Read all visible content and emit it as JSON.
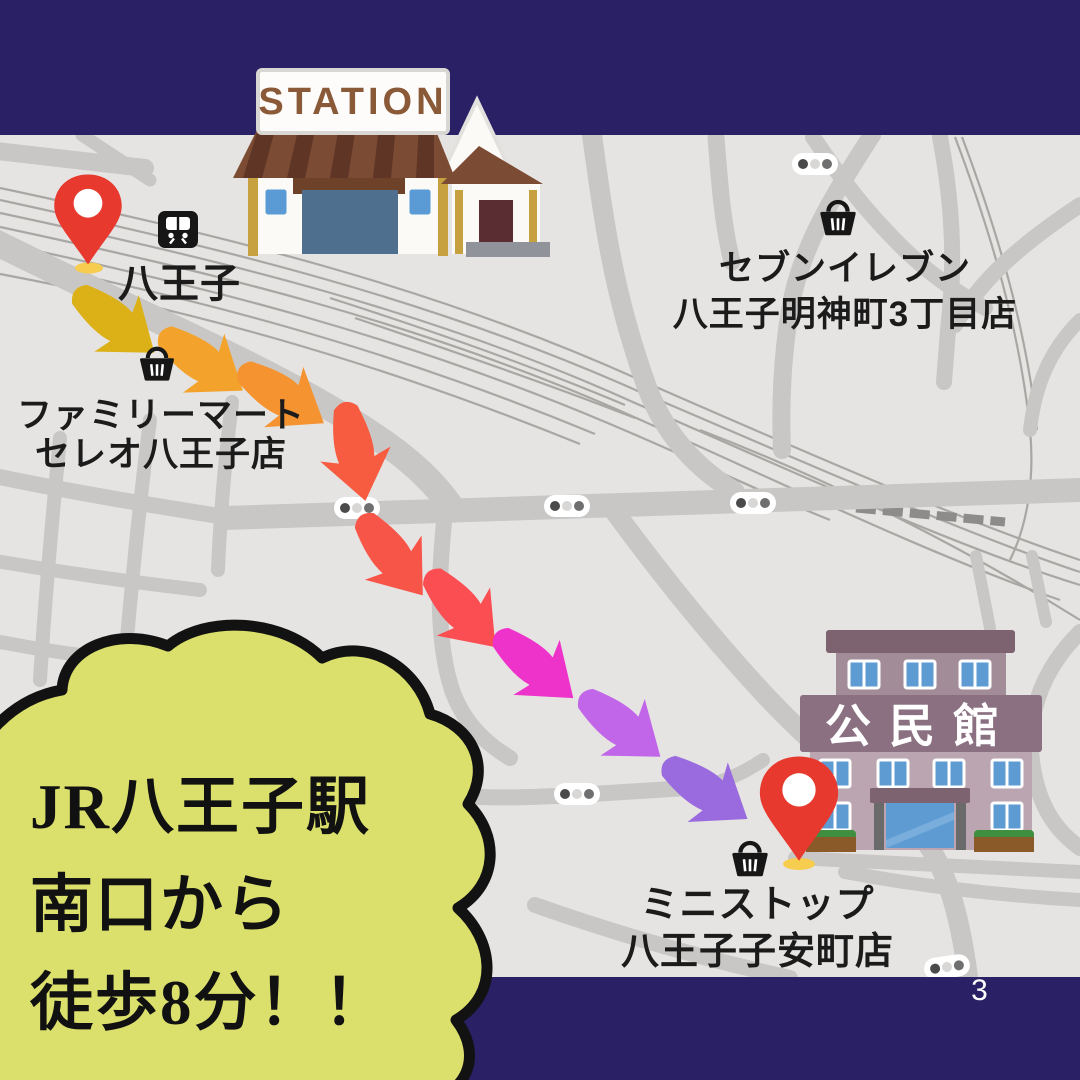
{
  "colors": {
    "banner_navy": "#2a2066",
    "map_background": "#e6e4e2",
    "road_gray": "#c9c7c5",
    "rail_gray": "#a9a7a4",
    "cloud_fill": "#dbe06c",
    "cloud_outline": "#121212",
    "pin_red": "#e8392f",
    "pin_shadow_yellow": "#f6cd4e",
    "station_roof_brown": "#7c4b33",
    "community_mauve": "#8a7080"
  },
  "footer": {
    "page_number": "3"
  },
  "callout": {
    "line1": "JR八王子駅",
    "line2": "南口から",
    "line3": "徒歩8分！！"
  },
  "station": {
    "sign": "STATION",
    "name": "八王子"
  },
  "pois": {
    "familymart": {
      "line1": "ファミリーマート",
      "line2": "セレオ八王子店"
    },
    "seven_eleven": {
      "line1": "セブンイレブン",
      "line2": "八王子明神町3丁目店"
    },
    "ministop": {
      "line1": "ミニストップ",
      "line2": "八王子子安町店"
    },
    "community_center": {
      "sign": "公民館"
    }
  },
  "route": {
    "arrows": [
      {
        "color": "#dcb117"
      },
      {
        "color": "#f3a32c"
      },
      {
        "color": "#f59331"
      },
      {
        "color": "#f75b40"
      },
      {
        "color": "#f85549"
      },
      {
        "color": "#fa4e52"
      },
      {
        "color": "#ee33cb"
      },
      {
        "color": "#c166e8"
      },
      {
        "color": "#9a6bdf"
      }
    ]
  }
}
